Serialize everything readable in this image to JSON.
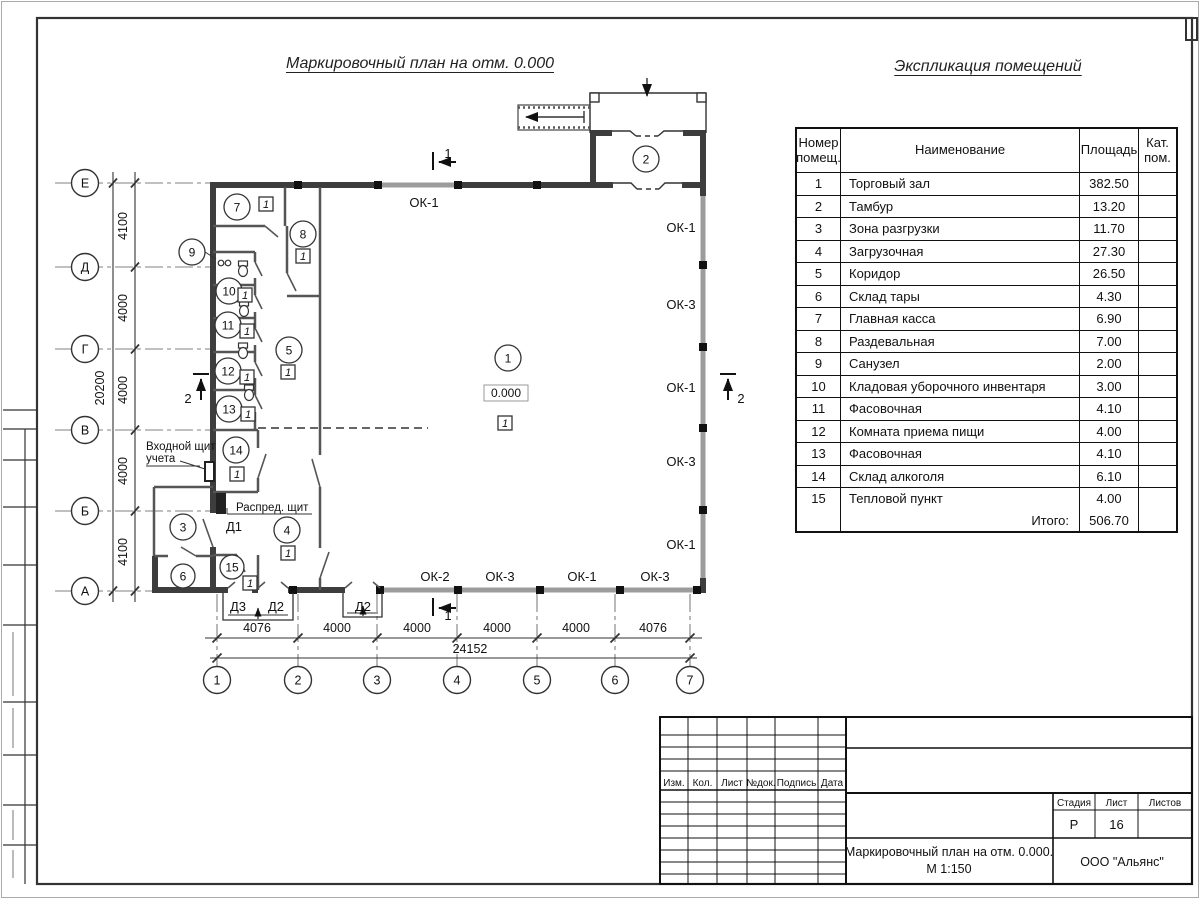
{
  "sheet": {
    "plan_title": "Маркировочный план на отм. 0.000",
    "table_title": "Экспликация помещений"
  },
  "table": {
    "headers": {
      "num1": "Номер",
      "num2": "помещ.",
      "name": "Наименование",
      "area": "Площадь",
      "cat1": "Кат.",
      "cat2": "пом."
    },
    "rows": [
      {
        "num": "1",
        "name": "Торговый зал",
        "area": "382.50",
        "cat": ""
      },
      {
        "num": "2",
        "name": "Тамбур",
        "area": "13.20",
        "cat": ""
      },
      {
        "num": "3",
        "name": "Зона разгрузки",
        "area": "11.70",
        "cat": ""
      },
      {
        "num": "4",
        "name": "Загрузочная",
        "area": "27.30",
        "cat": ""
      },
      {
        "num": "5",
        "name": "Коридор",
        "area": "26.50",
        "cat": ""
      },
      {
        "num": "6",
        "name": "Склад тары",
        "area": "4.30",
        "cat": ""
      },
      {
        "num": "7",
        "name": "Главная касса",
        "area": "6.90",
        "cat": ""
      },
      {
        "num": "8",
        "name": "Раздевальная",
        "area": "7.00",
        "cat": ""
      },
      {
        "num": "9",
        "name": "Санузел",
        "area": "2.00",
        "cat": ""
      },
      {
        "num": "10",
        "name": "Кладовая уборочного инвентаря",
        "area": "3.00",
        "cat": ""
      },
      {
        "num": "11",
        "name": "Фасовочная",
        "area": "4.10",
        "cat": ""
      },
      {
        "num": "12",
        "name": "Комната приема пищи",
        "area": "4.00",
        "cat": ""
      },
      {
        "num": "13",
        "name": "Фасовочная",
        "area": "4.10",
        "cat": ""
      },
      {
        "num": "14",
        "name": "Склад алкоголя",
        "area": "6.10",
        "cat": ""
      },
      {
        "num": "15",
        "name": "Тепловой пункт",
        "area": "4.00",
        "cat": ""
      }
    ],
    "total_label": "Итого:",
    "total_value": "506.70"
  },
  "plan": {
    "axes_rows": [
      "Е",
      "Д",
      "Г",
      "В",
      "Б",
      "А"
    ],
    "axes_cols": [
      "1",
      "2",
      "3",
      "4",
      "5",
      "6",
      "7"
    ],
    "dims_left": [
      "4100",
      "4000",
      "4000",
      "4000",
      "4100"
    ],
    "dim_left_total": "20200",
    "dims_bottom": [
      "4076",
      "4000",
      "4000",
      "4000",
      "4000",
      "4076"
    ],
    "dim_bottom_total": "24152",
    "windows_top": "ОК-1",
    "windows_right": [
      "ОК-1",
      "ОК-3",
      "ОК-1",
      "ОК-3",
      "ОК-1"
    ],
    "windows_bottom": [
      "ОК-2",
      "ОК-3",
      "ОК-1",
      "ОК-3"
    ],
    "door_d1": "Д1",
    "doors_bottom": [
      "Д3",
      "Д2",
      "Д2"
    ],
    "rooms": [
      "1",
      "2",
      "3",
      "4",
      "5",
      "6",
      "7",
      "8",
      "9",
      "10",
      "11",
      "12",
      "13",
      "14",
      "15"
    ],
    "floor_marker": "1",
    "elevation": "0.000",
    "section_1": "1",
    "section_2": "2",
    "annotations": {
      "entry_line1": "Входной щит",
      "entry_line2": "учета",
      "dist_board": "Распред. щит"
    }
  },
  "titleblock": {
    "cols": [
      "Изм.",
      "Кол.",
      "Лист",
      "№док.",
      "Подпись",
      "Дата"
    ],
    "stage_label": "Стадия",
    "sheet_label": "Лист",
    "sheets_label": "Листов",
    "stage": "Р",
    "sheet_num": "16",
    "doc_title_line1": "Маркировочный план на отм. 0.000.",
    "doc_title_line2": "М 1:150",
    "company": "ООО \"Альянс\""
  },
  "colors": {
    "line": "#1a1a1a",
    "wall": "#3d3d3d",
    "window_wall": "#9c9c9c",
    "grid": "#808080"
  }
}
